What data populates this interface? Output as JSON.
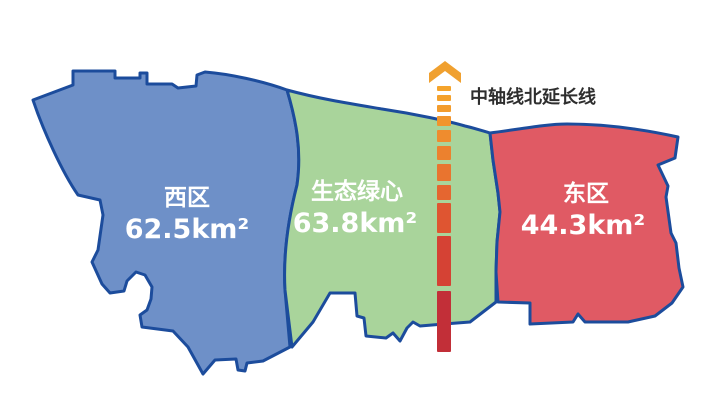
{
  "theme": {
    "background": "#FFFFFF",
    "outline": "#1C4C9C",
    "label_text": "#FFFFFF",
    "text_dark": "#2E2E2E"
  },
  "regions": {
    "west": {
      "name": "西区",
      "area": "62.5km²",
      "fill": "#6E90C8"
    },
    "center": {
      "name": "生态绿心",
      "area": "63.8km²",
      "fill": "#A9D49B"
    },
    "east": {
      "name": "东区",
      "area": "44.3km²",
      "fill": "#E05A64"
    }
  },
  "axis": {
    "label": "中轴线北延长线",
    "arrow_icon": "chevron-up",
    "arrow_color": "#F0A02F",
    "dashes": [
      {
        "y": 86,
        "h": 5,
        "c": "#F5A42C"
      },
      {
        "y": 95,
        "h": 6,
        "c": "#F4A12C"
      },
      {
        "y": 105,
        "h": 7,
        "c": "#F39C2D"
      },
      {
        "y": 116,
        "h": 10,
        "c": "#F1952D"
      },
      {
        "y": 130,
        "h": 12,
        "c": "#EF8C2E"
      },
      {
        "y": 146,
        "h": 14,
        "c": "#EC812E"
      },
      {
        "y": 164,
        "h": 17,
        "c": "#E9742F"
      },
      {
        "y": 185,
        "h": 15,
        "c": "#E56630"
      },
      {
        "y": 203,
        "h": 30,
        "c": "#DF5531"
      },
      {
        "y": 236,
        "h": 50,
        "c": "#D54234"
      },
      {
        "y": 291,
        "h": 61,
        "c": "#C22F38"
      }
    ]
  }
}
